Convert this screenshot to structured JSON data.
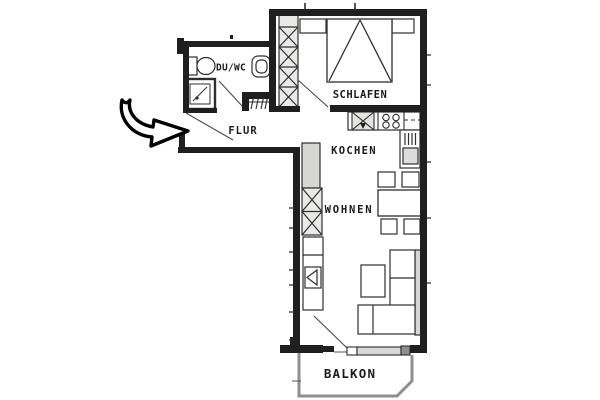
{
  "rooms": [
    {
      "id": "du-wc",
      "label": "DU/WC"
    },
    {
      "id": "schlafen",
      "label": "SCHLAFEN"
    },
    {
      "id": "flur",
      "label": "FLUR"
    },
    {
      "id": "kochen",
      "label": "KOCHEN"
    },
    {
      "id": "wohnen",
      "label": "WOHNEN"
    },
    {
      "id": "balkon",
      "label": "BALKON"
    }
  ],
  "fixtures": [
    "entrance-arrow",
    "entrance-door-swing",
    "wardrobe",
    "double-bed",
    "nightstand-left",
    "nightstand-right",
    "bedroom-door-swing",
    "toilet",
    "washbasin",
    "shower",
    "duwc-door-swing",
    "radiator",
    "kitchen-counter",
    "sink",
    "stove",
    "kitchen-tall-unit",
    "fridge",
    "kitchen-sideboard",
    "shelf-cabinet",
    "tv-cabinet",
    "dining-table",
    "dining-chairs",
    "sofa",
    "coffee-table",
    "balcony-door-swing",
    "balcony-window",
    "balcony-railing"
  ],
  "colors": {
    "wall": "#1f1f1f",
    "line": "#2e2e2e",
    "light_fill": "#e9e9e7",
    "mid_fill": "#d6d6d4",
    "railing": "#8f8f8f",
    "background": "#ffffff",
    "text": "#1b1b1b"
  }
}
